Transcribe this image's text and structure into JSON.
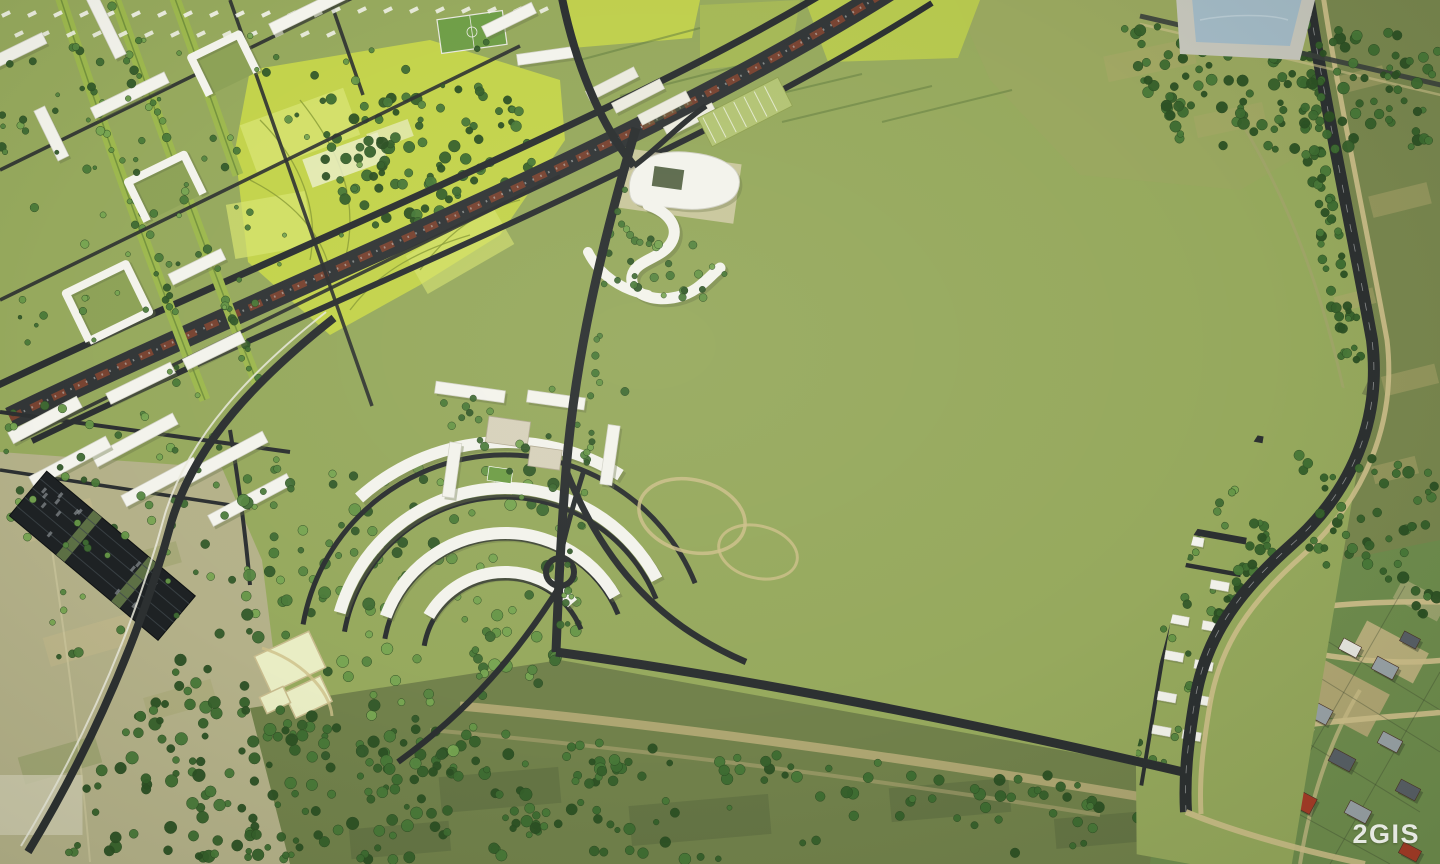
{
  "image": {
    "type": "aerial-3d-masterplan-render",
    "description": "Bird's-eye 3D render of a residential district master plan (white apartment blocks, townhouse rows, school with stadium, crescent quarter, railway corridor) blended into satellite photo terrain with fields and an existing village",
    "width_px": 1440,
    "height_px": 864
  },
  "watermark": {
    "text": "2GIS"
  },
  "palette": {
    "renderGrass": "#96a95d",
    "renderGrassLight": "#a6b96b",
    "courtyard": "#8da257",
    "parkYellow": "#c3d34b",
    "parkYellowLight": "#d7e470",
    "parkPale": "#e9edc4",
    "road": "#2c3031",
    "asphaltDark": "#1e2224",
    "railRed": "#7c4430",
    "railBed": "#323637",
    "building": "#f3f3ec",
    "buildingEdge": "#d2d2c6",
    "buildingShadow": "#697549",
    "campusBeige": "#d7d1bb",
    "campusBeigeEdge": "#b2ab92",
    "campusGray": "#a7a69e",
    "trackRing": "#c5d096",
    "field": "#6f9e47",
    "plaza": "#e2d8ac",
    "plazaEdge": "#c8bc8e",
    "dirtPath": "#cdbf8a",
    "sand": "#c2ae7e",
    "photoPale": "#b4b189",
    "photoOlive": "#79874f",
    "photoOliveDark": "#5a6940",
    "photoTan": "#b3a86e",
    "southField": "#71814b",
    "villageGrass": "#6f8d4e",
    "roofRed": "#a63b27",
    "roofRedDark": "#8c3522",
    "roofGray": "#9aa3a8",
    "roofSlate": "#596067",
    "roofWhite": "#e8e8e1",
    "pondWater": "#a3bac6",
    "pondRim": "#c6c6bc"
  },
  "regions": [
    {
      "id": "city-district-northwest",
      "label": "Existing city district of white perimeter blocks"
    },
    {
      "id": "central-park-band",
      "label": "Yellow-green park band with forest mass"
    },
    {
      "id": "railway-corridor",
      "label": "Diagonal railway corridor with train"
    },
    {
      "id": "industrial-halls",
      "label": "Industrial halls with sawtooth roofs"
    },
    {
      "id": "landmark-building",
      "label": "Curved landmark and serpentine buildings"
    },
    {
      "id": "masterplan-grid",
      "label": "New residential master plan grid"
    },
    {
      "id": "school-campus",
      "label": "School campus"
    },
    {
      "id": "stadium",
      "label": "Stadium with running track"
    },
    {
      "id": "townhouse-rows",
      "label": "Townhouse row quarters"
    },
    {
      "id": "suburban-houses-east",
      "label": "Low-rise suburban plots among trees"
    },
    {
      "id": "crescent-quarter",
      "label": "Crescent-shaped building quarter with roundabout"
    },
    {
      "id": "parking-strip",
      "label": "Dark garage/parking strip"
    },
    {
      "id": "eastern-highway",
      "label": "Eastern bypass road with tree line"
    },
    {
      "id": "pond",
      "label": "Pond in northeast corner"
    },
    {
      "id": "fields-northeast",
      "label": "Open olive fields northeast"
    },
    {
      "id": "fields-south",
      "label": "Open fields south"
    },
    {
      "id": "fields-west",
      "label": "Pale fields southwest"
    },
    {
      "id": "forest-southwest",
      "label": "Dense forest wedge southwest"
    },
    {
      "id": "village",
      "label": "Existing village with red roofs southeast"
    },
    {
      "id": "watermark",
      "label": "2GIS watermark"
    }
  ]
}
